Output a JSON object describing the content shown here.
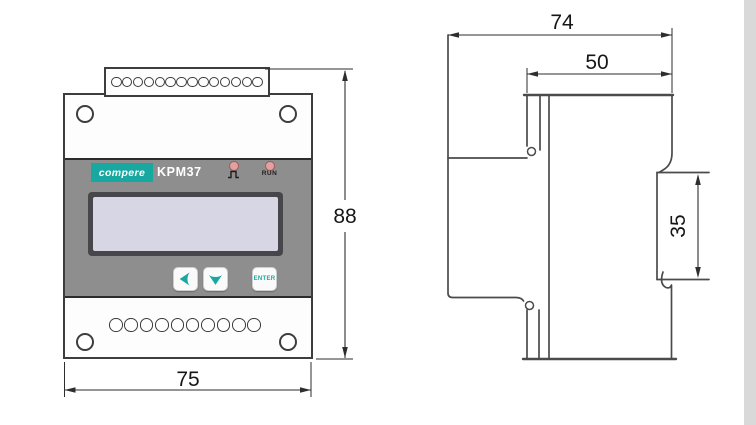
{
  "front_view": {
    "brand_logo": "compere",
    "model": "KPM37",
    "led_pulse_icon": "pulse-waveform-icon",
    "led_run_label": "RUN",
    "enter_button_label": "ENTER",
    "button_icons": [
      "left-arrow-icon",
      "down-arrow-icon"
    ],
    "top_terminal_count": 14,
    "bottom_terminal_count": 10,
    "height_dim": "88",
    "width_dim": "75"
  },
  "side_view": {
    "total_depth_dim": "74",
    "body_depth_dim": "50",
    "din_rail_dim": "35"
  },
  "colors": {
    "brand_teal": "#17a8a1",
    "panel_gray": "#8e8e8e",
    "lcd_screen": "#d6d6e4",
    "led_pink": "#e2a1a1",
    "line_dark": "#4b4b4b",
    "dim_line": "#2e2e2e",
    "edge_strip": "#d9d9d9"
  }
}
